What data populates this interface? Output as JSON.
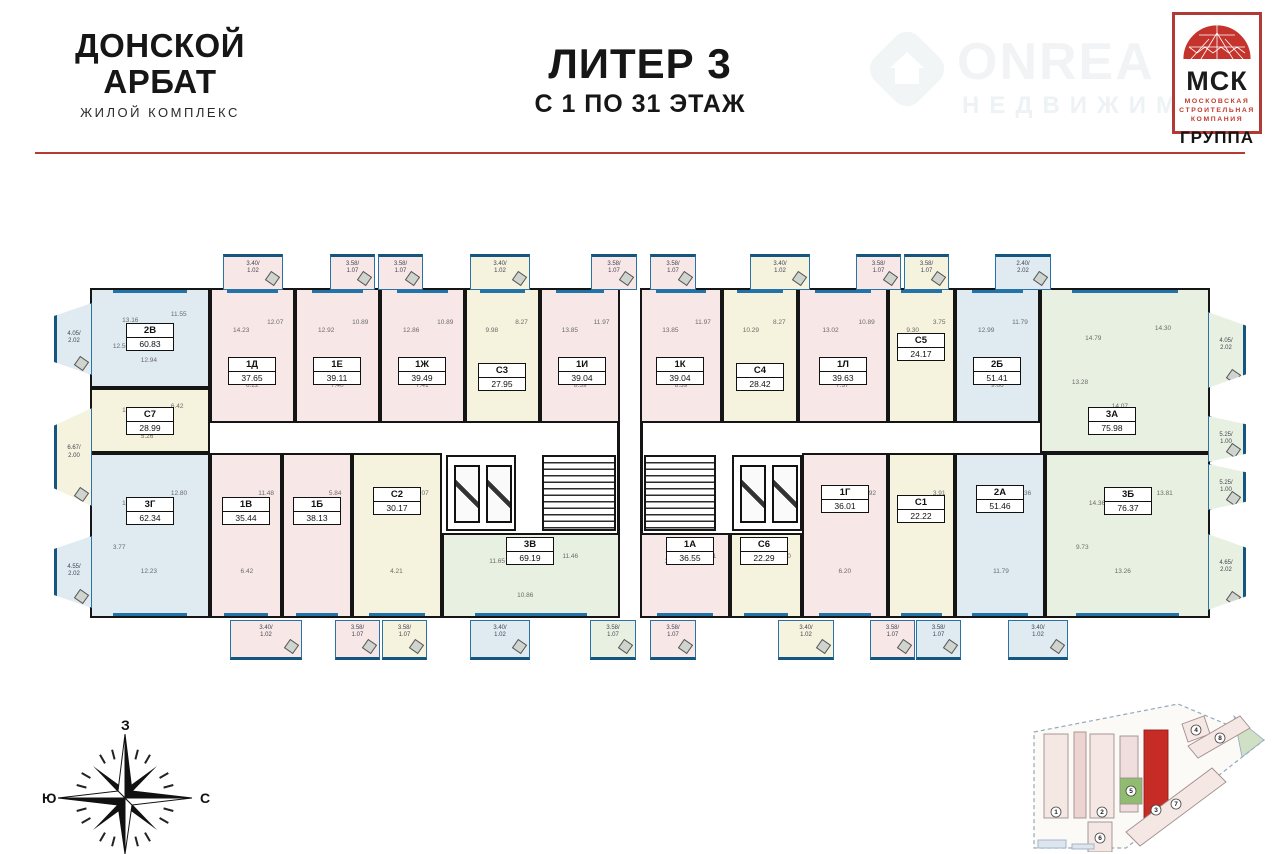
{
  "header": {
    "logo": {
      "line1": "ДОНСКОЙ",
      "line2": "АРБАТ",
      "subtitle": "ЖИЛОЙ КОМПЛЕКС"
    },
    "title": {
      "line1": "ЛИТЕР 3",
      "line2": "С 1 ПО 31 ЭТАЖ"
    },
    "watermark": {
      "line1": "ONREA",
      "line2": "НЕДВИЖИМ"
    },
    "msk_logo": {
      "abbr": "МСК",
      "line1": "МОСКОВСКАЯ",
      "line2": "СТРОИТЕЛЬНАЯ",
      "line3": "КОМПАНИЯ",
      "group": "ГРУППА"
    }
  },
  "colors": {
    "accent_red": "#b23b35",
    "wall": "#151515",
    "window_blue": "#2273a8",
    "pink": "#f8e7e7",
    "blue": "#dfeaf1",
    "cream": "#f5f2dd",
    "green": "#e8f1e1",
    "site_highlight": "#c62b26"
  },
  "plan": {
    "wings": [
      {
        "x": 40,
        "y": 40,
        "w": 530,
        "h": 330
      },
      {
        "x": 590,
        "y": 40,
        "w": 570,
        "h": 330
      }
    ],
    "apartments": [
      {
        "code": "2В",
        "area": "60.83",
        "tint": "blue",
        "row": "top",
        "x": 40,
        "y": 40,
        "w": 120,
        "h": 100,
        "lx": 100,
        "ly": 88,
        "rooms": [
          "13.16",
          "11.55",
          "12.94",
          "12.56"
        ]
      },
      {
        "code": "С7",
        "area": "28.99",
        "tint": "cream",
        "row": "mid",
        "x": 40,
        "y": 140,
        "w": 120,
        "h": 65,
        "lx": 100,
        "ly": 172,
        "rooms": [
          "10.32",
          "6.42",
          "5.26"
        ]
      },
      {
        "code": "1Д",
        "area": "37.65",
        "tint": "pink",
        "row": "top",
        "x": 160,
        "y": 40,
        "w": 85,
        "h": 135,
        "lx": 202,
        "ly": 122,
        "rooms": [
          "14.23",
          "12.07",
          "6.22"
        ]
      },
      {
        "code": "1Е",
        "area": "39.11",
        "tint": "pink",
        "row": "top",
        "x": 245,
        "y": 40,
        "w": 85,
        "h": 135,
        "lx": 287,
        "ly": 122,
        "rooms": [
          "12.92",
          "10.89",
          "7.40"
        ]
      },
      {
        "code": "1Ж",
        "area": "39.49",
        "tint": "pink",
        "row": "top",
        "x": 330,
        "y": 40,
        "w": 85,
        "h": 135,
        "lx": 372,
        "ly": 122,
        "rooms": [
          "12.86",
          "10.89",
          "7.41"
        ]
      },
      {
        "code": "С3",
        "area": "27.95",
        "tint": "cream",
        "row": "top",
        "x": 415,
        "y": 40,
        "w": 75,
        "h": 135,
        "lx": 452,
        "ly": 128,
        "rooms": [
          "9.98",
          "8.27",
          "4.37"
        ]
      },
      {
        "code": "1И",
        "area": "39.04",
        "tint": "pink",
        "row": "top",
        "x": 490,
        "y": 40,
        "w": 80,
        "h": 135,
        "lx": 532,
        "ly": 122,
        "rooms": [
          "13.85",
          "11.97",
          "8.39"
        ]
      },
      {
        "code": "3Г",
        "area": "62.34",
        "tint": "blue",
        "row": "bottom",
        "x": 40,
        "y": 205,
        "w": 120,
        "h": 165,
        "lx": 100,
        "ly": 262,
        "rooms": [
          "12.35",
          "12.80",
          "12.23",
          "3.77"
        ]
      },
      {
        "code": "1В",
        "area": "35.44",
        "tint": "pink",
        "row": "bottom",
        "x": 160,
        "y": 205,
        "w": 72,
        "h": 165,
        "lx": 196,
        "ly": 262,
        "rooms": [
          "12.15",
          "11.48",
          "6.42"
        ]
      },
      {
        "code": "1Б",
        "area": "38.13",
        "tint": "pink",
        "row": "bottom",
        "x": 232,
        "y": 205,
        "w": 70,
        "h": 165,
        "lx": 267,
        "ly": 262,
        "rooms": [
          "12.97",
          "5.84"
        ]
      },
      {
        "code": "С2",
        "area": "30.17",
        "tint": "cream",
        "row": "bottom",
        "x": 302,
        "y": 205,
        "w": 90,
        "h": 165,
        "lx": 347,
        "ly": 252,
        "rooms": [
          "10.77",
          "10.07",
          "4.21"
        ]
      },
      {
        "code": "3В",
        "area": "69.19",
        "tint": "green",
        "row": "bottom",
        "x": 392,
        "y": 285,
        "w": 178,
        "h": 85,
        "lx": 480,
        "ly": 302,
        "rooms": [
          "11.65",
          "11.46",
          "10.86"
        ]
      },
      {
        "code": "1К",
        "area": "39.04",
        "tint": "pink",
        "row": "top",
        "x": 590,
        "y": 40,
        "w": 82,
        "h": 135,
        "lx": 630,
        "ly": 122,
        "rooms": [
          "13.85",
          "11.97",
          "8.39"
        ]
      },
      {
        "code": "С4",
        "area": "28.42",
        "tint": "cream",
        "row": "top",
        "x": 672,
        "y": 40,
        "w": 76,
        "h": 135,
        "lx": 710,
        "ly": 128,
        "rooms": [
          "10.29",
          "8.27",
          "4.10"
        ]
      },
      {
        "code": "1Л",
        "area": "39.63",
        "tint": "pink",
        "row": "top",
        "x": 748,
        "y": 40,
        "w": 90,
        "h": 135,
        "lx": 793,
        "ly": 122,
        "rooms": [
          "13.02",
          "10.89",
          "7.37"
        ]
      },
      {
        "code": "С5",
        "area": "24.17",
        "tint": "cream",
        "row": "top",
        "x": 838,
        "y": 40,
        "w": 67,
        "h": 135,
        "lx": 871,
        "ly": 98,
        "rooms": [
          "9.30",
          "3.75"
        ]
      },
      {
        "code": "2Б",
        "area": "51.41",
        "tint": "blue",
        "row": "top",
        "x": 905,
        "y": 40,
        "w": 85,
        "h": 135,
        "lx": 947,
        "ly": 122,
        "rooms": [
          "12.99",
          "11.79",
          "9.66"
        ]
      },
      {
        "code": "3А",
        "area": "75.98",
        "tint": "green",
        "row": "top",
        "x": 990,
        "y": 40,
        "w": 170,
        "h": 165,
        "lx": 1062,
        "ly": 172,
        "rooms": [
          "14.79",
          "14.30",
          "14.07",
          "13.28"
        ]
      },
      {
        "code": "1А",
        "area": "36.55",
        "tint": "pink",
        "row": "bottom",
        "x": 590,
        "y": 285,
        "w": 90,
        "h": 85,
        "lx": 640,
        "ly": 302,
        "rooms": [
          "10.92",
          "11.61"
        ]
      },
      {
        "code": "С6",
        "area": "22.29",
        "tint": "cream",
        "row": "bottom",
        "x": 680,
        "y": 285,
        "w": 72,
        "h": 85,
        "lx": 714,
        "ly": 302,
        "rooms": [
          "11.10",
          "4.50"
        ]
      },
      {
        "code": "1Г",
        "area": "36.01",
        "tint": "pink",
        "row": "bottom",
        "x": 752,
        "y": 205,
        "w": 86,
        "h": 165,
        "lx": 795,
        "ly": 250,
        "rooms": [
          "11.77",
          "12.92",
          "6.20"
        ]
      },
      {
        "code": "С1",
        "area": "22.22",
        "tint": "cream",
        "row": "bottom",
        "x": 838,
        "y": 205,
        "w": 67,
        "h": 165,
        "lx": 871,
        "ly": 260,
        "rooms": [
          "9.30",
          "3.91"
        ]
      },
      {
        "code": "2А",
        "area": "51.46",
        "tint": "blue",
        "row": "bottom",
        "x": 905,
        "y": 205,
        "w": 90,
        "h": 165,
        "lx": 950,
        "ly": 250,
        "rooms": [
          "12.99",
          "11.36",
          "11.79"
        ]
      },
      {
        "code": "3Б",
        "area": "76.37",
        "tint": "green",
        "row": "bottom",
        "x": 995,
        "y": 205,
        "w": 165,
        "h": 165,
        "lx": 1078,
        "ly": 252,
        "rooms": [
          "14.36",
          "13.81",
          "13.26",
          "9.73"
        ]
      }
    ],
    "cores": [
      {
        "type": "elevators",
        "x": 396,
        "y": 207,
        "w": 70,
        "h": 76
      },
      {
        "type": "stairs",
        "x": 492,
        "y": 207,
        "w": 74,
        "h": 76
      },
      {
        "type": "stairs",
        "x": 594,
        "y": 207,
        "w": 72,
        "h": 76
      },
      {
        "type": "elevators",
        "x": 682,
        "y": 207,
        "w": 70,
        "h": 76
      }
    ],
    "balconies_top": [
      {
        "x": 173,
        "w": 60,
        "label": "3.40/",
        "label2": "1.02",
        "tint": "pink"
      },
      {
        "x": 280,
        "w": 45,
        "label": "3.58/",
        "label2": "1.07",
        "tint": "pink"
      },
      {
        "x": 328,
        "w": 45,
        "label": "3.58/",
        "label2": "1.07",
        "tint": "pink"
      },
      {
        "x": 420,
        "w": 60,
        "label": "3.40/",
        "label2": "1.02",
        "tint": "cream"
      },
      {
        "x": 541,
        "w": 46,
        "label": "3.58/",
        "label2": "1.07",
        "tint": "pink"
      },
      {
        "x": 600,
        "w": 46,
        "label": "3.58/",
        "label2": "1.07",
        "tint": "pink"
      },
      {
        "x": 700,
        "w": 60,
        "label": "3.40/",
        "label2": "1.02",
        "tint": "cream"
      },
      {
        "x": 806,
        "w": 45,
        "label": "3.58/",
        "label2": "1.07",
        "tint": "pink"
      },
      {
        "x": 854,
        "w": 45,
        "label": "3.58/",
        "label2": "1.07",
        "tint": "cream"
      },
      {
        "x": 945,
        "w": 56,
        "label": "2.40/",
        "label2": "2.02",
        "tint": "blue"
      }
    ],
    "balconies_bottom": [
      {
        "x": 180,
        "w": 72,
        "label": "3.40/",
        "label2": "1.02",
        "tint": "pink"
      },
      {
        "x": 285,
        "w": 45,
        "label": "3.58/",
        "label2": "1.07",
        "tint": "pink"
      },
      {
        "x": 332,
        "w": 45,
        "label": "3.58/",
        "label2": "1.07",
        "tint": "cream"
      },
      {
        "x": 420,
        "w": 60,
        "label": "3.40/",
        "label2": "1.02",
        "tint": "blue"
      },
      {
        "x": 540,
        "w": 46,
        "label": "3.58/",
        "label2": "1.07",
        "tint": "green"
      },
      {
        "x": 600,
        "w": 46,
        "label": "3.58/",
        "label2": "1.07",
        "tint": "pink"
      },
      {
        "x": 728,
        "w": 56,
        "label": "3.40/",
        "label2": "1.02",
        "tint": "cream"
      },
      {
        "x": 820,
        "w": 45,
        "label": "3.58/",
        "label2": "1.07",
        "tint": "pink"
      },
      {
        "x": 866,
        "w": 45,
        "label": "3.58/",
        "label2": "1.07",
        "tint": "blue"
      },
      {
        "x": 958,
        "w": 60,
        "label": "3.40/",
        "label2": "1.02",
        "tint": "blue"
      }
    ],
    "balconies_left": [
      {
        "y": 55,
        "h": 72,
        "label": "4.05/",
        "label2": "2.02",
        "tint": "blue"
      },
      {
        "y": 160,
        "h": 98,
        "label": "6.67/",
        "label2": "2.00",
        "tint": "cream"
      },
      {
        "y": 288,
        "h": 72,
        "label": "4.55/",
        "label2": "2.02",
        "tint": "blue"
      }
    ],
    "balconies_right": [
      {
        "y": 64,
        "h": 76,
        "label": "4.05/",
        "label2": "2.02",
        "tint": "green"
      },
      {
        "y": 168,
        "h": 46,
        "label": "5.25/",
        "label2": "1.00",
        "tint": "green"
      },
      {
        "y": 216,
        "h": 46,
        "label": "5.25/",
        "label2": "1.00",
        "tint": "green"
      },
      {
        "y": 286,
        "h": 76,
        "label": "4.65/",
        "label2": "2.02",
        "tint": "green"
      }
    ]
  },
  "compass": {
    "top": "З",
    "left": "Ю",
    "right": "С"
  },
  "site_plan": {
    "highlighted": "3",
    "buildings": [
      {
        "num": "1",
        "cx": 28,
        "cy": 112
      },
      {
        "num": "2",
        "cx": 74,
        "cy": 112
      },
      {
        "num": "3",
        "cx": 128,
        "cy": 110
      },
      {
        "num": "4",
        "cx": 168,
        "cy": 30
      },
      {
        "num": "5",
        "cx": 103,
        "cy": 91
      },
      {
        "num": "6",
        "cx": 72,
        "cy": 138
      },
      {
        "num": "7",
        "cx": 148,
        "cy": 104
      },
      {
        "num": "8",
        "cx": 192,
        "cy": 38
      }
    ]
  }
}
